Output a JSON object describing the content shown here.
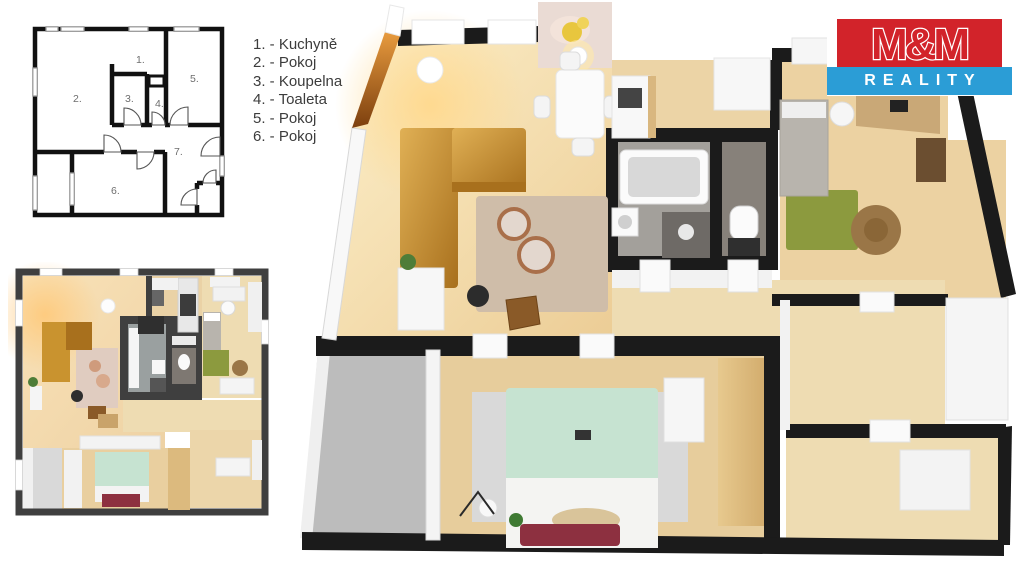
{
  "legend": {
    "items": [
      {
        "label": "1. - Kuchyně"
      },
      {
        "label": "2. - Pokoj"
      },
      {
        "label": "3. - Koupelna"
      },
      {
        "label": "4. - Toaleta"
      },
      {
        "label": "5. - Pokoj"
      },
      {
        "label": "6. - Pokoj"
      }
    ]
  },
  "plan2d": {
    "room_labels": [
      "1.",
      "2.",
      "3.",
      "4.",
      "5.",
      "6.",
      "7."
    ]
  },
  "logo": {
    "top_text": "M&M",
    "bottom_text": "REALITY"
  },
  "colors": {
    "wall_dark": "#1b1b1b",
    "wall_small": "#3f3f3f",
    "wall_face": "#f2f2f2",
    "wood": "#e9cf9f",
    "wood_light": "#eedcb2",
    "wood_warm": "#f6e2ae",
    "wood_band": "#dcba7e",
    "floor_gray": "#bcbcbc",
    "tile_gray": "#a3a09b",
    "tile_dark": "#87817a",
    "sofa_gold": "#c9932f",
    "sofa_gold_dark": "#a8701d",
    "bed_mint": "#c6e3d1",
    "rug_olive": "#8c9a3e",
    "rug_beige": "#cfbda9",
    "rug_gray": "#d9d9d9",
    "maroon": "#8d3040",
    "pouf_brown": "#9a7647",
    "bed_gray": "#b8b4ad",
    "desk_wood": "#c9a877",
    "logo_red": "#d2232a",
    "logo_blue": "#2b9dd6",
    "plan_line": "#111111",
    "plan_text": "#6e6e6e",
    "legend_text": "#3c3c3c"
  }
}
